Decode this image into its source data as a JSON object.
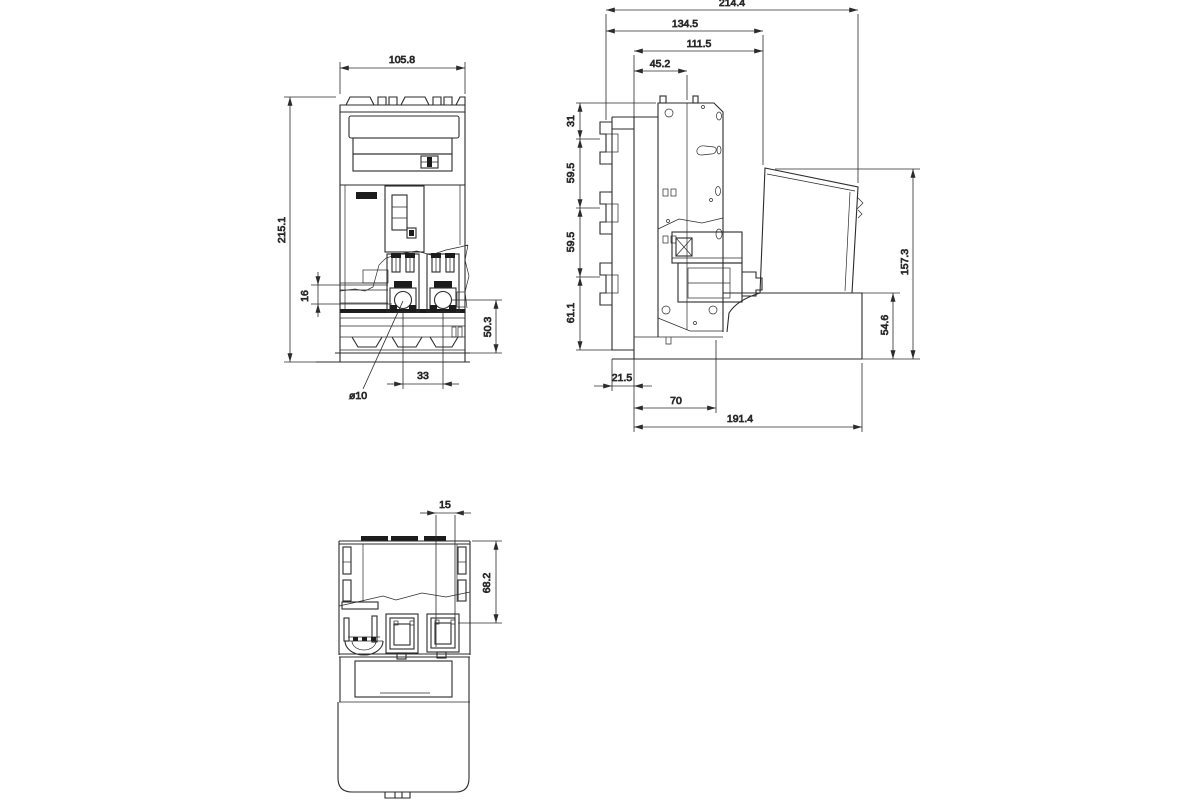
{
  "dims": {
    "front": {
      "overall_width": "105.8",
      "overall_height": "215.1",
      "contact_offset": "16",
      "base_height": "50.3",
      "terminal_spacing": "33",
      "hole_diameter": "ø10"
    },
    "side": {
      "overall_depth": "214.4",
      "upper_depth": "134.5",
      "inner_depth": "111.5",
      "plate_depth": "45.2",
      "top_offset": "31",
      "pitch_upper": "59.5",
      "pitch_lower": "59.5",
      "bottom_offset": "61.1",
      "handle_height": "157.3",
      "base_front_height": "54.6",
      "rail_offset": "21.5",
      "base_depth": "70",
      "mounting_depth": "191.4"
    },
    "bottom": {
      "slot_width": "15",
      "terminal_depth": "68.2"
    }
  },
  "colors": {
    "line": "#2b2b2b",
    "text": "#111111",
    "background": "#ffffff"
  }
}
